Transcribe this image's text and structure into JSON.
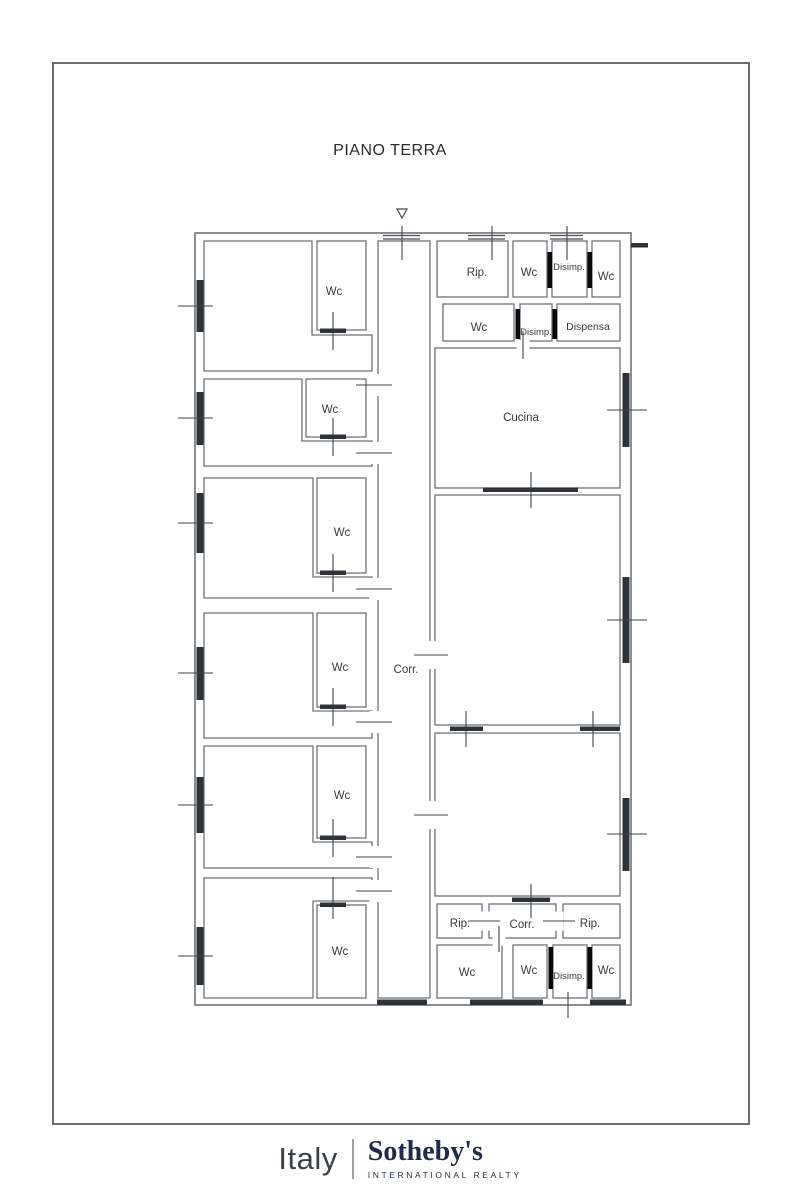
{
  "page": {
    "title": "PIANO TERRA"
  },
  "plan": {
    "labels": {
      "wc1": "Wc",
      "wc2": "Wc",
      "wc3": "Wc",
      "wc4": "Wc",
      "wc5": "Wc",
      "wc6": "Wc",
      "corridor": "Corr.",
      "rip_top": "Rip.",
      "wc_top_1": "Wc",
      "disimp_top": "Disimp.",
      "wc_top_2": "Wc",
      "wc_mid": "Wc",
      "disimp_mid": "Disimp.",
      "dispensa": "Dispensa",
      "cucina": "Cucina",
      "rip_bottom_1": "Rip.",
      "corr_bottom": "Corr.",
      "rip_bottom_2": "Rip.",
      "wc_bottom_1": "Wc",
      "wc_bottom_2": "Wc",
      "disimp_bottom": "Disimp.",
      "wc_bottom_3": "Wc"
    }
  },
  "footer": {
    "region": "Italy",
    "brand": "Sotheby's",
    "brand_sub": "INTERNATIONAL REALTY"
  },
  "colors": {
    "wall_gray": "#6e7378",
    "window_dark": "#2f3237",
    "door_black": "#0a0a0a",
    "brand_navy": "#1f2b4c",
    "frame_gray": "#666c74"
  }
}
